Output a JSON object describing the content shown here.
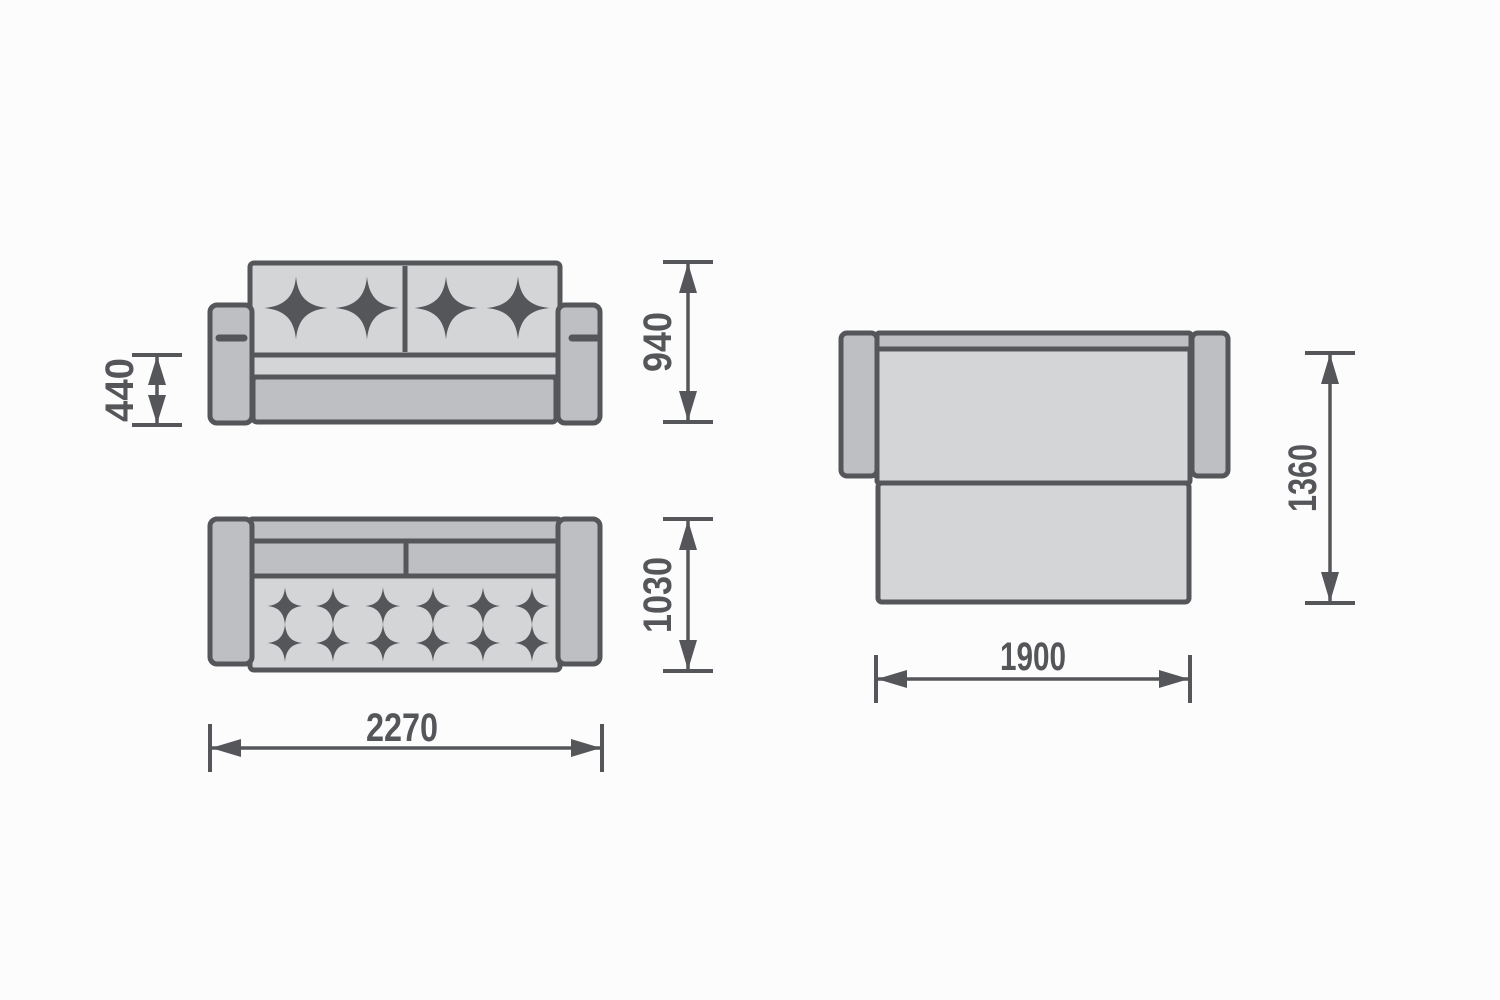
{
  "diagram": {
    "kind": "furniture-dimension-drawing",
    "subject": "sofa-bed",
    "views": {
      "front": "sofa front elevation",
      "top": "sofa top plan",
      "bed": "unfolded bed plan"
    }
  },
  "dimensions": {
    "seat_height": "440",
    "overall_height": "940",
    "overall_depth": "1030",
    "overall_width": "2270",
    "bed_length": "1360",
    "bed_width": "1900"
  },
  "colors": {
    "bg": "#fcfcfc",
    "ink": "#54565a",
    "fill-light": "#d3d5d7",
    "fill-medium": "#bdbfc2"
  }
}
